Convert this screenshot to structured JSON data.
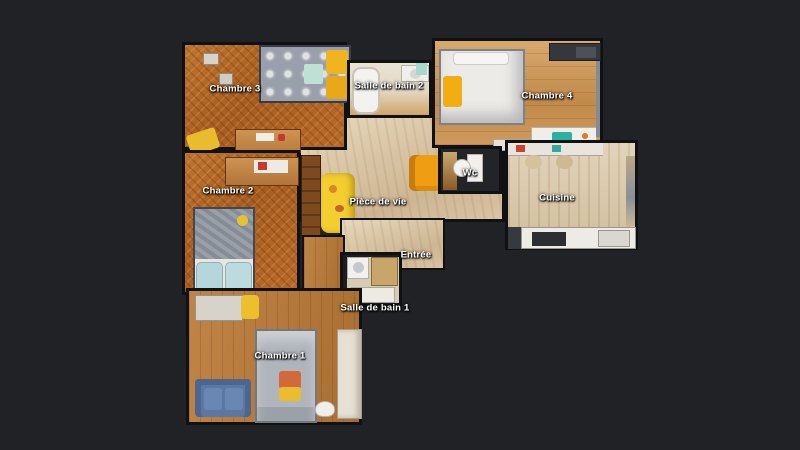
{
  "scene": {
    "type": "apartment-floorplan-top-view",
    "colors": {
      "background": "#212226",
      "wall": "#101115",
      "parquet_herringbone": "#b06524",
      "wood_light_planks": "#cf9a5e",
      "wood_pale": "#d9c7a9",
      "wood_medium": "#b67c3f",
      "accent_yellow": "#f0b41e",
      "label_text": "#ffffff"
    }
  },
  "plan": {
    "rooms": [
      {
        "id": "chambre-3",
        "label": "Chambre 3"
      },
      {
        "id": "salle-de-bain-2",
        "label": "Salle de bain 2"
      },
      {
        "id": "chambre-4",
        "label": "Chambre 4"
      },
      {
        "id": "chambre-2",
        "label": "Chambre 2"
      },
      {
        "id": "piece-de-vie",
        "label": "Pièce de vie"
      },
      {
        "id": "wc",
        "label": "Wc"
      },
      {
        "id": "cuisine",
        "label": "Cuisine"
      },
      {
        "id": "entree",
        "label": "Entrée"
      },
      {
        "id": "salle-de-bain-1",
        "label": "Salle de bain 1"
      },
      {
        "id": "chambre-1",
        "label": "Chambre 1"
      }
    ]
  }
}
